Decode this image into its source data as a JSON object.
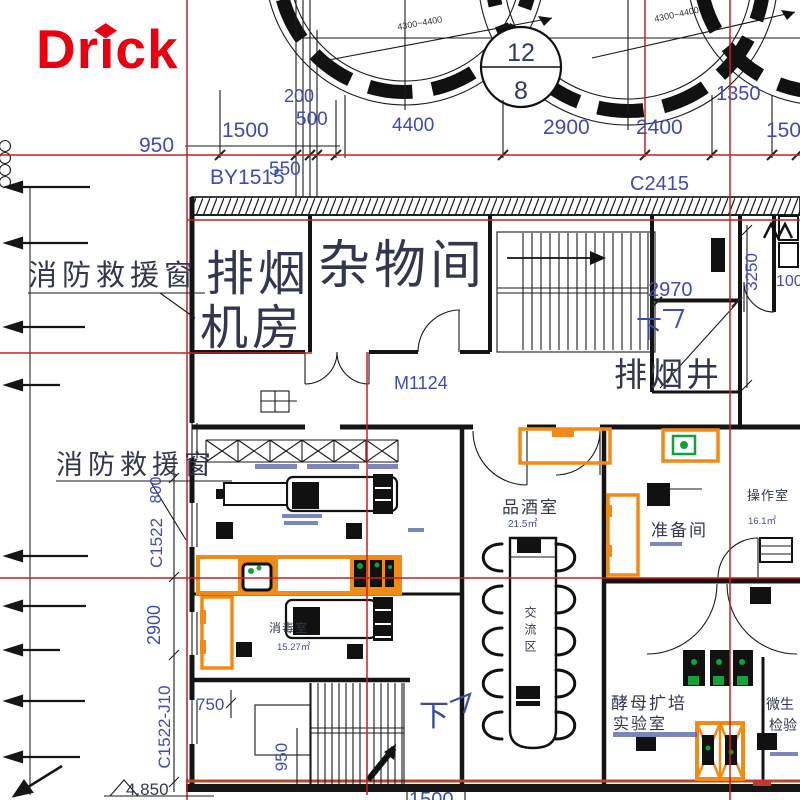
{
  "logo": {
    "text": "Drick",
    "diamond": "◆"
  },
  "colors": {
    "grid_red": "#c32222",
    "dim_blue": "#3f4cac",
    "label_dark": "#32374e",
    "highlight_orange": "#f28a16",
    "equip_green": "#12a13c",
    "logo_red": "#e60012",
    "bottom_line_red": "#b5472a"
  },
  "axis_bubble": {
    "top": "12",
    "bottom": "8"
  },
  "tank_callouts": {
    "left": "4300~4400",
    "right": "4300~4400"
  },
  "top_dimensions": {
    "d950": "950",
    "d1500": "1500",
    "d200": "200",
    "d500": "500",
    "d550": "550",
    "by1515": "BY1515",
    "d4400": "4400",
    "d2900": "2900",
    "d2400": "2400",
    "d1350": "1350",
    "d1500b": "1500",
    "c2415": "C2415"
  },
  "rooms": {
    "paiyan_line1": "排烟",
    "paiyan_line2": "机房",
    "zawujian": "杂物间",
    "paiyanjing": "排烟井",
    "pinjiushi": "品酒室",
    "pinjiushi_area": "21.5㎡",
    "zhunbeijian": "准备间",
    "caozuoshi": "操作室",
    "caozuoshi_area": "16.1㎡",
    "xiaodushi": "消毒室",
    "xiaodushi_area": "15.27㎡",
    "jiaomu_line1": "酵母扩培",
    "jiaomu_line2": "实验室",
    "weisheng_line1": "微生",
    "weisheng_line2": "检验",
    "jiaoliu": "交流区"
  },
  "annotations": {
    "fire_window_1": "消防救援窗",
    "fire_window_2": "消防救援窗",
    "m1124": "M1124",
    "down_top": "下",
    "down_bottom": "下",
    "d2970": "2970",
    "d3250": "3250",
    "d1000": "1000",
    "d800v": "800",
    "c1522": "C1522",
    "d2900v": "2900",
    "c1522j": "C1522-J10",
    "d750": "750",
    "d950v": "950",
    "d1500_bottom": "1500",
    "elevation": "4.850"
  }
}
